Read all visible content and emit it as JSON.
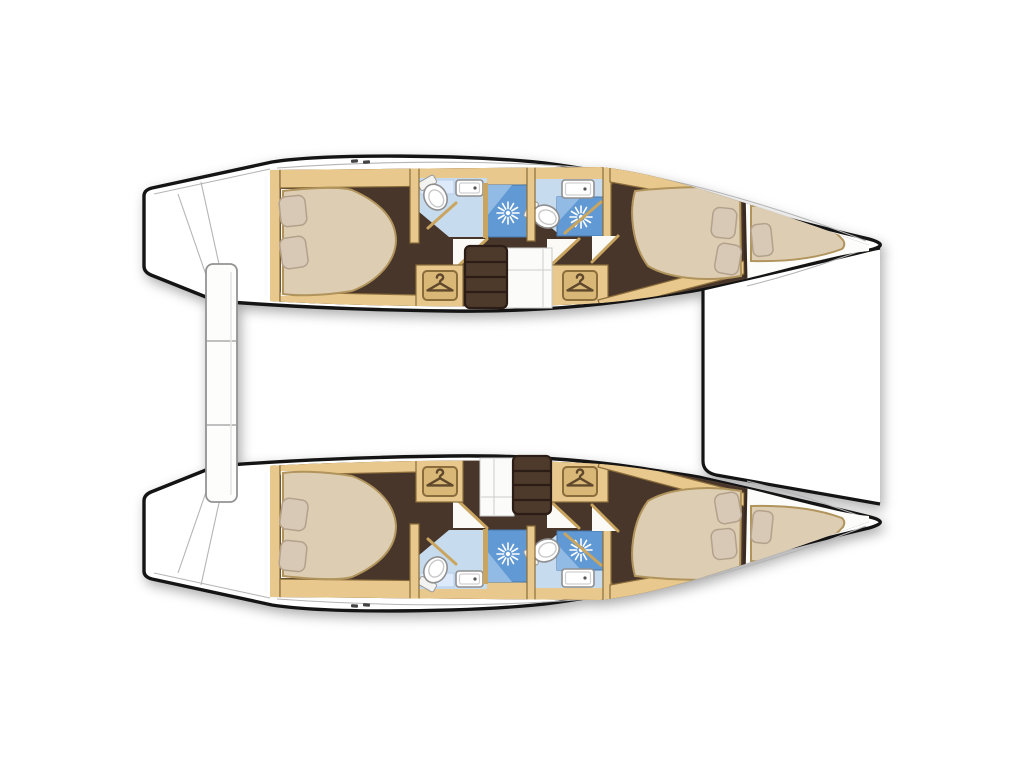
{
  "page": {
    "title": "Catamaran layout plan"
  },
  "diagram": {
    "type": "boat-floorplan",
    "subject": "Four-cabin sailing catamaran deck plan, top view, bow to the right",
    "hulls": [
      {
        "name": "port hull (top)",
        "rooms": [
          "aft double cabin",
          "aft bathroom with shower",
          "forward bathroom with shower",
          "wardrobe",
          "wardrobe",
          "companionway steps",
          "forward double cabin",
          "forepeak berth"
        ]
      },
      {
        "name": "starboard hull (bottom)",
        "rooms": [
          "aft double cabin",
          "aft bathroom with shower",
          "forward bathroom with shower",
          "wardrobe",
          "wardrobe",
          "companionway steps",
          "forward double cabin",
          "forepeak berth"
        ]
      }
    ],
    "between_hulls": [
      "aft gangway plank",
      "forward trampoline deck"
    ],
    "counts": {
      "double_beds": 4,
      "forepeak_berths": 2,
      "toilets": 4,
      "showers": 4,
      "sinks": 4,
      "wardrobe_icons": 4,
      "step_flights": 2
    },
    "icons": [
      {
        "name": "hanger-icon",
        "meaning": "wardrobe / closet"
      },
      {
        "name": "shower-head-icon",
        "meaning": "shower rose sunburst"
      },
      {
        "name": "toilet-icon",
        "meaning": "marine toilet"
      },
      {
        "name": "sink-icon",
        "meaning": "washbasin"
      }
    ]
  },
  "colors": {
    "outline": "#141414",
    "wood": "#e8c88c",
    "woodedge": "#8a6d3b",
    "wooddark": "#caa55f",
    "floor": "#48362b",
    "floordark": "#2b1d15",
    "step": "#4e3a2b",
    "bed": "#ddcdb3",
    "bedstroke": "#b1945c",
    "pillow": "#d8c9b6",
    "bath": "#c7dbee",
    "bathpanel": "#ddeafb",
    "shower": "#6099d3",
    "showerlight": "#91bae4",
    "plate": "#d9b777",
    "hanger": "#5f482c",
    "deckline": "#b5b5b5"
  }
}
